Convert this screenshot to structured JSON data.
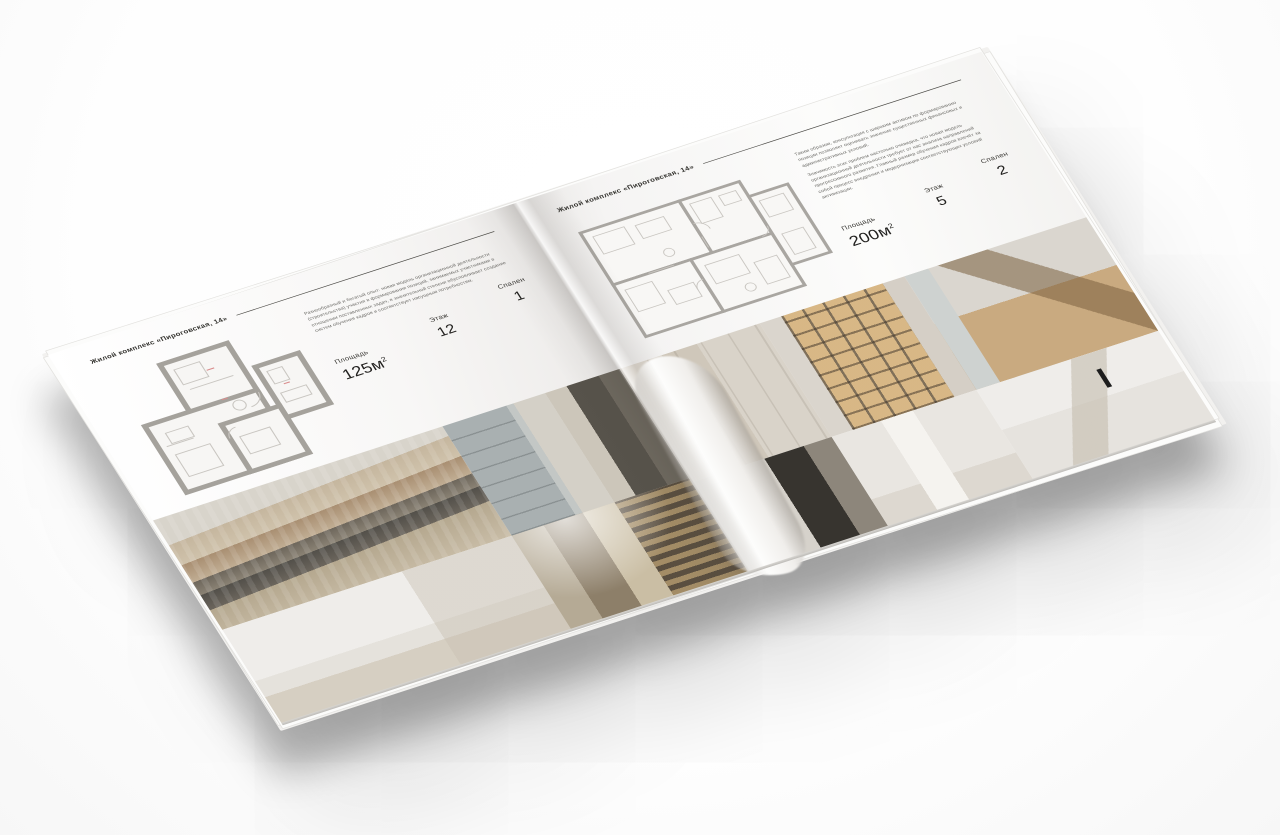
{
  "brochure": {
    "left_page": {
      "header": "Жилой комплекс «Пироговская, 14»",
      "description": "Разнообразный и богатый опыт: новая модель организационной деятельности (строительства) участия в формировании позиций, занимаемых участниками в отношении поставленных задач, в значительной степени обусловливает создание систем обучения кадров и соответствует насущным потребностям.",
      "stats": [
        {
          "label": "Площадь",
          "value": "125м",
          "sup": "2"
        },
        {
          "label": "Этаж",
          "value": "12"
        },
        {
          "label": "Спален",
          "value": "1"
        }
      ],
      "floor_plan": "План квартиры 125 м²",
      "photos": [
        "bedroom-pillows",
        "window-lounge",
        "white-bedroom",
        "hallway-bookshelves"
      ]
    },
    "right_page": {
      "header": "Жилой комплекс «Пироговская, 14»",
      "paragraphs": [
        "Таким образом, консультация с широким активом по формированию позиции позволяет оценивать значение существенных финансовых и административных условий.",
        "Значимость этих проблем настолько очевидна, что новая модель организационной деятельности требует от нас анализа направлений прогрессивного развития. Главный размер обучения кадров влечёт за собой процесс внедрения и модернизации соответствующих условий активизации."
      ],
      "stats": [
        {
          "label": "Площадь",
          "value": "200м",
          "sup": "2"
        },
        {
          "label": "Этаж",
          "value": "5"
        },
        {
          "label": "Спален",
          "value": "2"
        }
      ],
      "floor_plan": "План квартиры 200 м²",
      "photos": [
        "beige-cabinet",
        "wardrobe-lit",
        "study-desk",
        "kitchen-dark",
        "bathroom-towel",
        "bath-sink"
      ]
    },
    "colors": {
      "paper": "#fafaf9",
      "plan_wall_gray": "#a5a29c",
      "photo_beige": "#cfc5b4",
      "shadow": "rgba(0,0,0,0.28)"
    }
  }
}
